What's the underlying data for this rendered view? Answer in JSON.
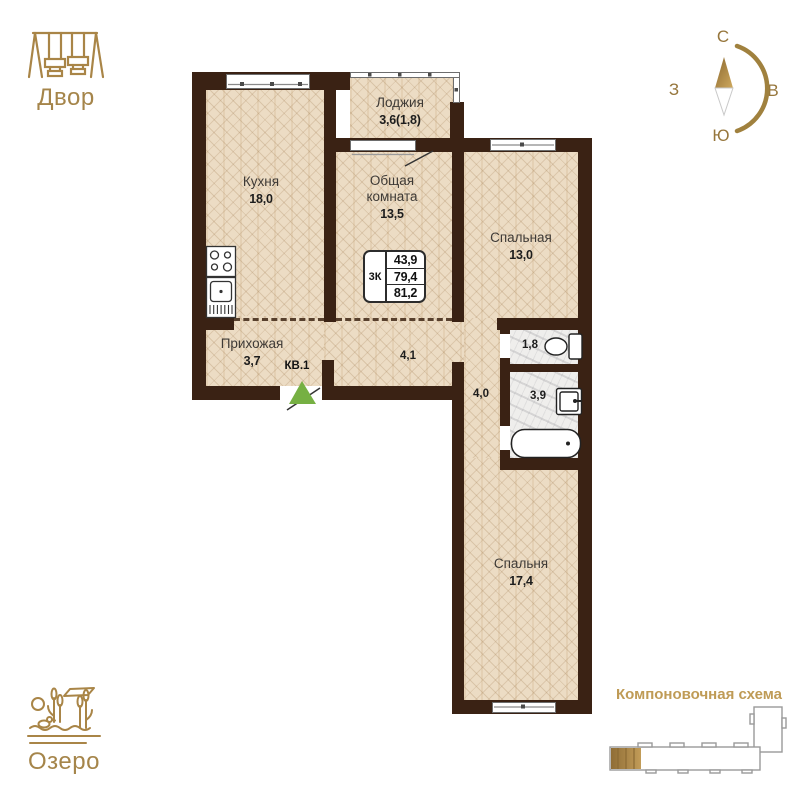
{
  "landmarks": {
    "yard": {
      "label": "Двор",
      "icon": "swing-set-icon"
    },
    "lake": {
      "label": "Озеро",
      "icon": "lake-icon"
    },
    "scheme": {
      "label": "Компоновочная схема",
      "highlighted_section": "first-left"
    }
  },
  "compass": {
    "n": "С",
    "e": "В",
    "s": "Ю",
    "w": "З"
  },
  "plan": {
    "unit": "КВ.1",
    "info_box": {
      "type": "3К",
      "area_living": "43,9",
      "area_main": "79,4",
      "area_total": "81,2"
    },
    "rooms": {
      "kitchen": {
        "name": "Кухня",
        "area": "18,0"
      },
      "loggia": {
        "name": "Лоджия",
        "area": "3,6(1,8)"
      },
      "living": {
        "name": "Общая комната",
        "area": "13,5"
      },
      "bedroom1": {
        "name": "Спальная",
        "area": "13,0"
      },
      "hallway": {
        "name": "Прихожая",
        "area": "3,7"
      },
      "bedroom2": {
        "name": "Спальня",
        "area": "17,4"
      },
      "corridor1": {
        "area": "4,1"
      },
      "corridor2": {
        "area": "4,0"
      },
      "wc": {
        "area": "1,8"
      },
      "bathroom": {
        "area": "3,9"
      }
    }
  },
  "colors": {
    "wall": "#3a2214",
    "floor_parquet": "#ecdcc4",
    "floor_marble": "#efeeec",
    "gold_accent": "#a98547",
    "entry_arrow_green": "#76b043"
  }
}
